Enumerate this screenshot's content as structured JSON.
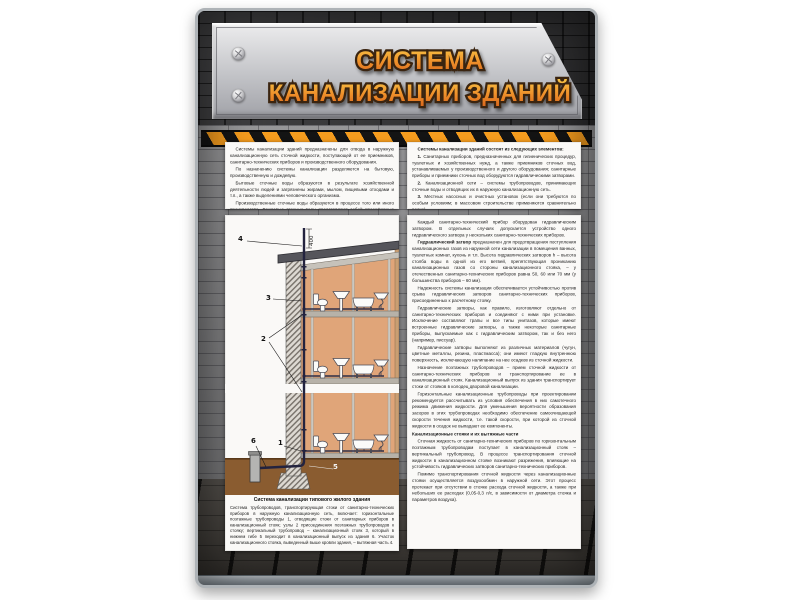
{
  "poster": {
    "title_line1": "СИСТЕМА",
    "title_line2": "КАНАЛИЗАЦИИ ЗДАНИЙ",
    "colors": {
      "title_orange_top": "#f8bc3e",
      "title_orange_bottom": "#d96a1c",
      "title_outline": "#3a2410",
      "hazard_orange": "#f59c1e",
      "interior_tan": "#e0a579",
      "ground_brown": "#8a5c30",
      "plate_gray": "#c2c3c7"
    },
    "intro": {
      "paragraphs": [
        {
          "text": "Системы канализации зданий предназначены для отвода в наружную канализационную сеть сточной жидкости, поступающей от ее приемников, санитарно-технических приборов и производственного оборудования."
        },
        {
          "text": "По назначению системы канализации разделяются на бытовую, производственную и дождевую."
        },
        {
          "text": "Бытовые сточные воды образуются в результате хозяйственной деятельности людей и загрязнены жирами, мылом, пищевыми отходами и т.п., а также выделениями человеческого организма."
        },
        {
          "text": "Производственные сточные воды образуются в процессе того или иного производства. Дождевые сточные воды представляют собой атмосферные осадки и талые воды."
        }
      ]
    },
    "elements": {
      "heading": "Системы канализации зданий состоят из следующих элементов:",
      "items": [
        {
          "num": "1.",
          "text": "Санитарных приборов, предназначенных для гигиенических процедур, туалетных и хозяйственных нужд, а также приемников сточных вод, устанавливаемых у производственного и другого оборудования; санитарные приборы и приемники сточных вод оборудуются гидравлическими затворами."
        },
        {
          "num": "2.",
          "text": "Канализационной сети – системы трубопроводов, принимающих сточные воды и отводящих их в наружную канализационную сеть."
        },
        {
          "num": "3.",
          "text": "Местных насосных и очистных установок (если они требуются по особым условиям; в массовом строительстве применяются сравнительно редко)."
        }
      ]
    },
    "right_col": {
      "paragraphs": [
        {
          "text": "Каждый санитарно-технический прибор оборудован гидравлическим затвором. В отдельных случаях допускается устройство одного гидравлического затвора у нескольких санитарно-технических приборов."
        },
        {
          "lead": "Гидравлический затвор",
          "text": "предназначен для предотвращения поступления канализационных газов из наружной сети канализации в помещения ванных, туалетных комнат, кухонь и т.п. Высота гидравлических затворов h – высота столба воды в одной из его ветвей, препятствующая прониканию канализационных газов со стороны канализационного стояка, – у отечественных санитарно-технических приборов равна 50, 60 или 70 мм (у большинства приборов – 60 мм)."
        },
        {
          "text": "Надежность системы канализации обеспечивается устойчивостью против срыва гидравлических затворов санитарно-технических приборов, присоединенных к расчетному стояку."
        },
        {
          "text": "Гидравлические затворы, как правило, изготовляют отдельно от санитарно-технических приборов и соединяют с ними при установке. Исключение составляют трапы и все типы унитазов, которые имеют встроенные гидравлические затворы, а также некоторые санитарные приборы, выпускаемые как с гидравлическим затвором, так и без него (например, писсуар)."
        },
        {
          "text": "Гидравлические затворы выполняют из различных материалов (чугун, цветные металлы, резина, пластмасса); они имеют гладкую внутреннюю поверхность, исключающую налипание на нее осадков из сточной жидкости."
        },
        {
          "text": "Назначение поэтажных трубопроводов – прием сточной жидкости от санитарно-технических приборов и транспортирование ее в канализационный стояк. Канализационный выпуск из здания транспортирует стоки от стояков в колодец дворовой канализации."
        },
        {
          "text": "Горизонтальные канализационные трубопроводы при проектировании рекомендуется рассчитывать из условия обеспечения в них самотечного режима движения жидкости. Для уменьшения вероятности образования засоров в этих трубопроводах необходимо обеспечение самоочищающей скорости течения жидкости, т.е. такой скорости, при которой из сточной жидкости в осадок не выпадают ее компоненты."
        },
        {
          "heading": "Канализационные стояки и их вытяжные части"
        },
        {
          "text": "Сточная жидкость от санитарно-технических приборов по горизонтальным поэтажным трубопроводам поступает в канализационный стояк – вертикальный трубопровод. В процессе транспортирования сточной жидкости в канализационном стояке возникают разрежения, влияющие на устойчивость гидравлических затворов санитарно-технических приборов."
        },
        {
          "text": "Помимо транспортирования сточной жидкости через канализационные стояки осуществляется воздухообмен в наружной сети. Этот процесс протекает при отсутствии в стояке расхода сточной жидкости, а также при небольших ее расходах (0,05-0,3 л/с, в зависимости от диаметра стояка и параметров воздуха)."
        }
      ]
    },
    "diagram": {
      "dim": "400",
      "labels": {
        "vent": "4",
        "stack": "3",
        "junctions": "2",
        "floor_pipe": "1",
        "bend": "5",
        "outlet": "6"
      },
      "caption_title": "Система канализации типового жилого здания",
      "caption_text": "Система трубопроводов, транспортирующая стоки от санитарно-технических приборов в наружную канализационную сеть, включает: горизонтальные поэтажные трубопроводы 1, отводящие стоки от санитарных приборов в канализационный стояк; узлы 2 присоединения поэтажных трубопроводов к стояку; вертикальный трубопровод – канализационный стояк 3, который в нижнем гибе 5 переходит в канализационный выпуск из здания 6. Участок канализационного стояка, выведенный выше кровли здания, – вытяжная часть 4."
    }
  }
}
